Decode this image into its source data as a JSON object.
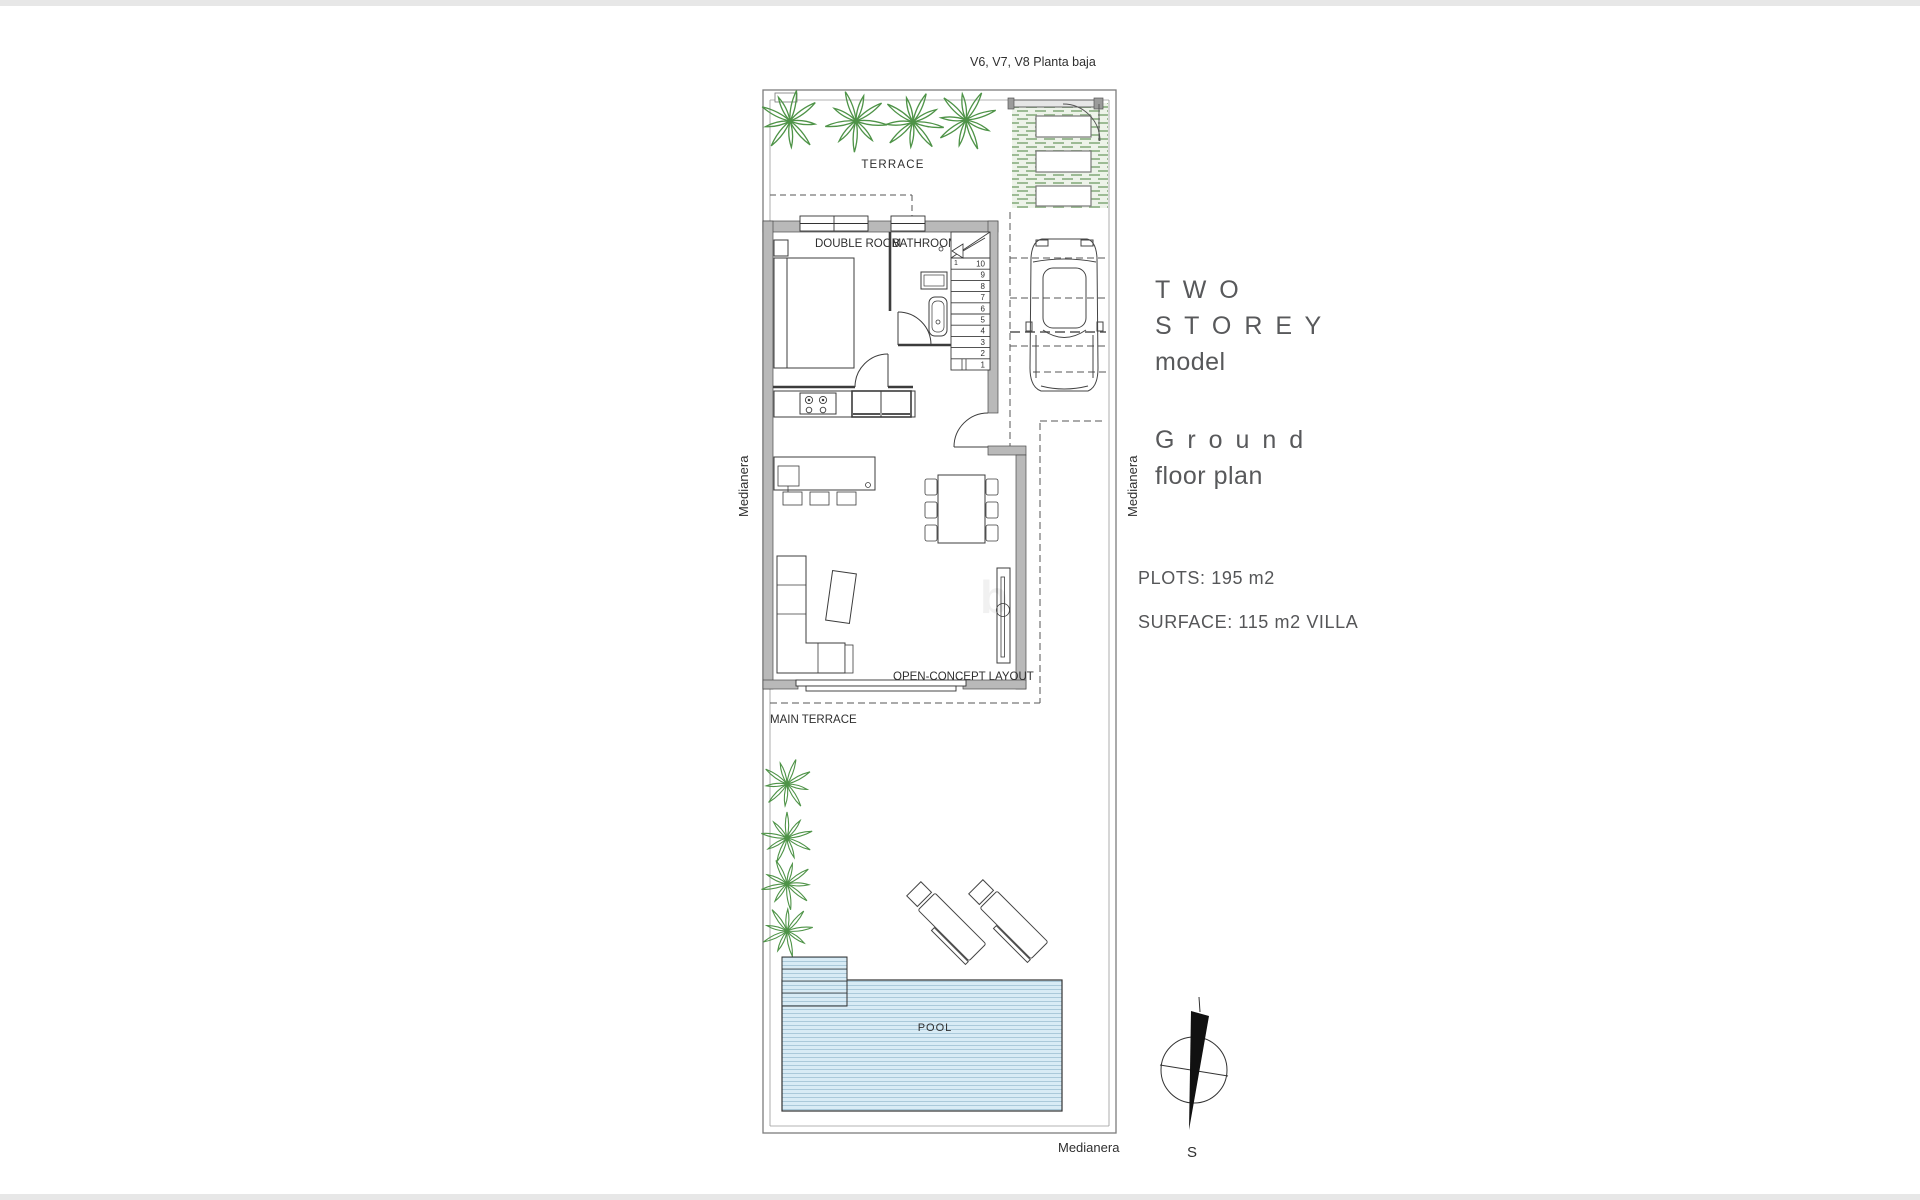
{
  "header": {
    "plan_code": "V6, V7, V8 Planta baja"
  },
  "floor_plan": {
    "labels": {
      "terrace": "TERRACE",
      "double_room": "DOUBLE ROOM",
      "bathroom": "BATHROOM",
      "open_concept": "OPEN-CONCEPT LAYOUT",
      "main_terrace": "MAIN TERRACE",
      "pool": "POOL",
      "boundary_left": "Medianera",
      "boundary_right": "Medianera",
      "boundary_bottom": "Medianera"
    },
    "staircase": {
      "steps": [
        "10",
        "9",
        "8",
        "7",
        "6",
        "5",
        "4",
        "3",
        "2",
        "1"
      ],
      "start_label": "1"
    },
    "compass": {
      "south_label": "S"
    },
    "watermark_text": "b"
  },
  "info_panel": {
    "model_title_line1": "T W O",
    "model_title_line2": "S T O R E Y",
    "model_subtitle": "model",
    "plan_title_line1": "G r o u n d",
    "plan_title_line2": "floor plan",
    "plots": "PLOTS: 195 m2",
    "surface": "SURFACE: 115 m2 VILLA"
  },
  "colors": {
    "wall_fill": "#b9b9b9",
    "line": "#3c3c3c",
    "palm_green": "#4e9347",
    "pool_blue": "#d8ebf5",
    "pool_stripe": "#aac9da",
    "grass_bg": "#edf3e9",
    "grass_dash": "#9cbb94",
    "panel_text": "#58595b"
  }
}
